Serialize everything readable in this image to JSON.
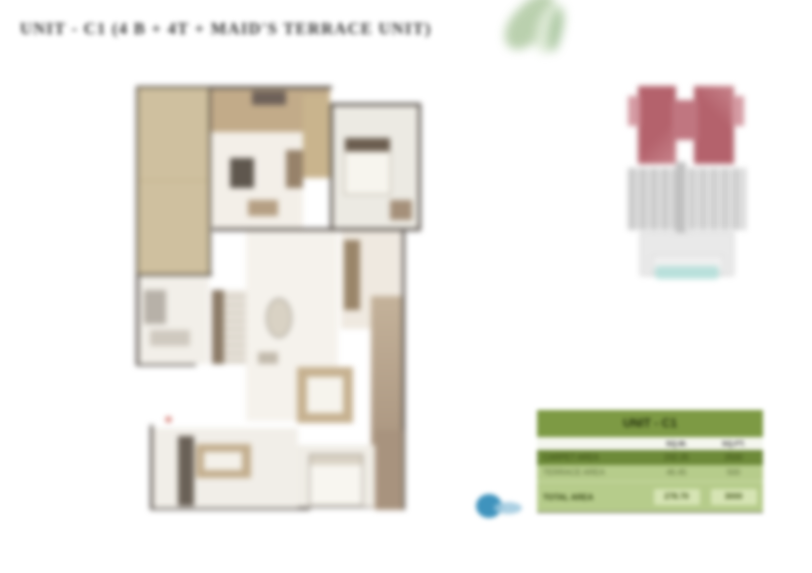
{
  "title": {
    "text": "UNIT - C1 (4 B + 4T + MAID'S TERRACE UNIT)"
  },
  "colors": {
    "terrace_tan": "#cfc09f",
    "wall_dark": "#57504a",
    "table_header_green": "#7d9a44",
    "table_dark_row_green": "#6d8a39",
    "table_light_row_green": "#b6cc8b",
    "keyplan_highlight_red": "#b4626c",
    "keyplan_gray": "#c9c9c9",
    "keyplan_teal": "#b9e0db",
    "north_arrow_blue": "#3f93bd",
    "leaf_green": "#aec8a0"
  },
  "area_table": {
    "title": "UNIT - C1",
    "columns": {
      "label": "",
      "sqm": "SQ.M.",
      "sqft": "SQ.FT."
    },
    "rows": [
      {
        "label": "CARPET AREA",
        "sqm": "232.25",
        "sqft": "2500"
      },
      {
        "label": "TERRACE AREA",
        "sqm": "46.45",
        "sqft": "500"
      },
      {
        "label": "TOTAL AREA",
        "sqm": "278.70",
        "sqft": "3000"
      }
    ]
  }
}
